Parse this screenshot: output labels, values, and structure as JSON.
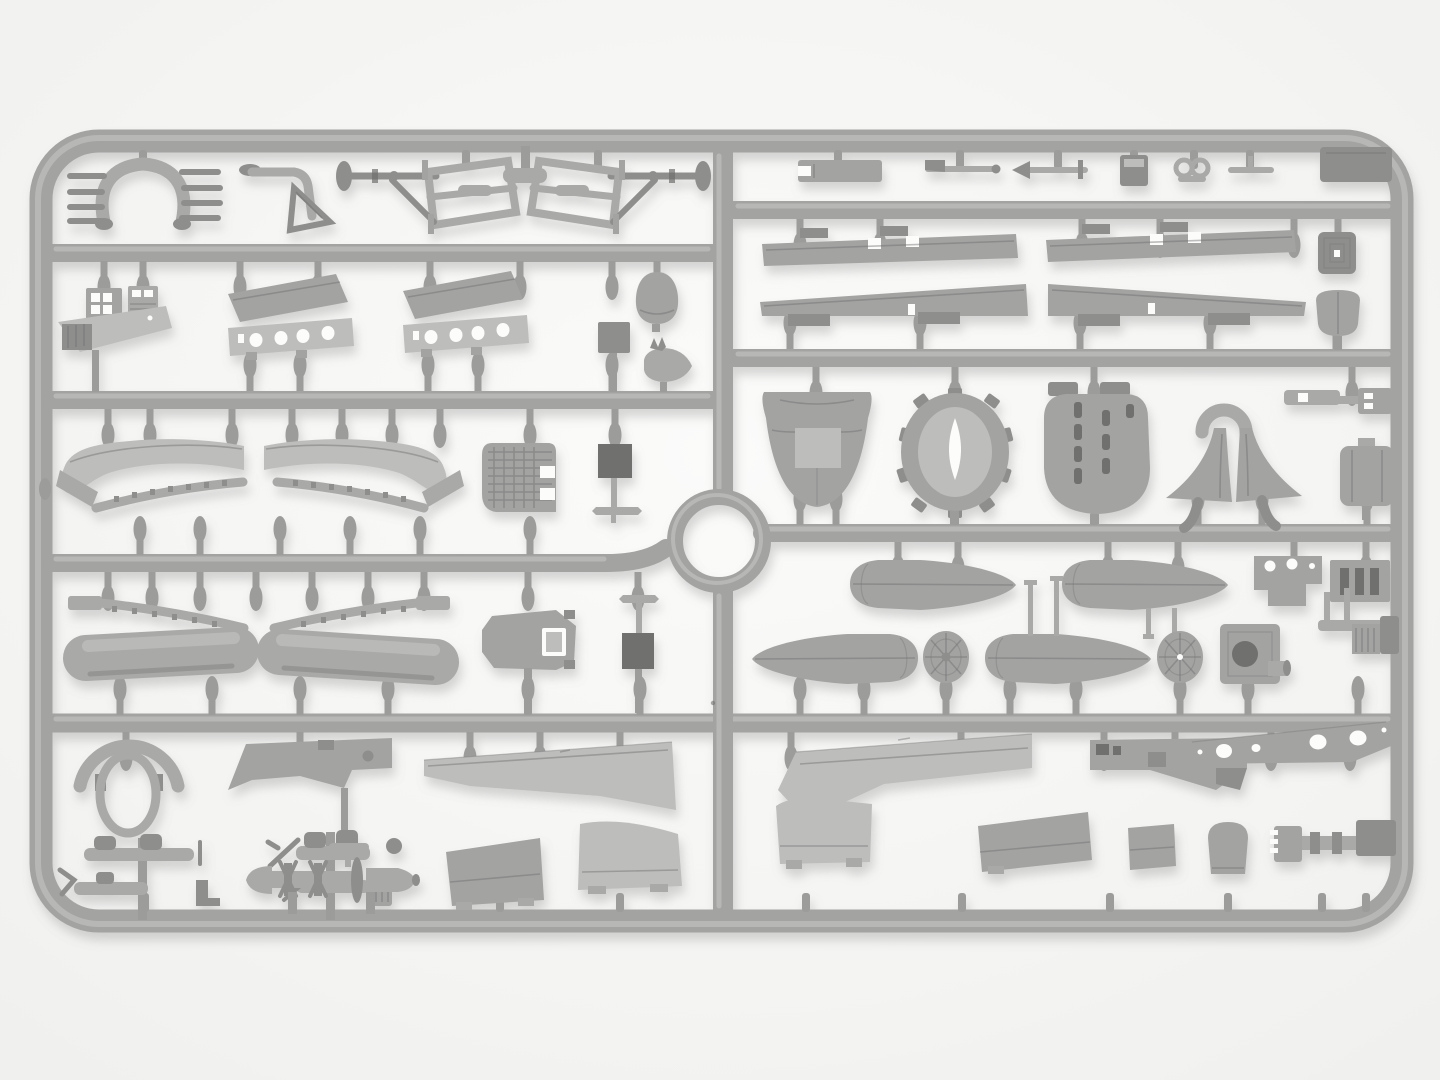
{
  "scene": {
    "kind": "photograph",
    "subject": "injection-molded light-gray styrene sprue of a model aircraft kit, shot on a plain white studio background",
    "orientation": "landscape",
    "sprue_structure": {
      "outer_frame": "rounded rectangle",
      "horizontal_runners_left": 4,
      "horizontal_runners_right": 3,
      "full_width_runner_bottom": 1,
      "vertical_center_divider": true,
      "circular_runner_hub_center": true,
      "gate_count_approx": 80
    }
  },
  "palette": {
    "bg-center": "#fbfbfa",
    "bg-edge": "#f0f0ee",
    "runner-base": "#a3a3a2",
    "runner-highlight": "#c9c9c7",
    "gate-gray": "#9c9c9b",
    "plastic-base": "#a9a9a8",
    "plastic-light": "#bdbdbc",
    "plastic-mid": "#a3a3a2",
    "plastic-dark": "#8e8e8d",
    "plastic-deep": "#6f6f6e",
    "plastic-outline": "#787877",
    "hole-white": "#fcfcfb",
    "shadow": "#8a8a88"
  },
  "parts": [
    {
      "id": "exhaust-collector",
      "label": "Y-shaped exhaust collector with stub pipes",
      "section": "left-row-1"
    },
    {
      "id": "control-column-bracket",
      "label": "bent control column with triangular gusset",
      "section": "left-row-1"
    },
    {
      "id": "landing-gear-frame-left",
      "label": "tubular landing gear frame with axle, left",
      "section": "left-row-1"
    },
    {
      "id": "landing-gear-frame-right",
      "label": "tubular landing gear frame with axle, right",
      "section": "left-row-1"
    },
    {
      "id": "t-connector",
      "label": "T-shaped runner drop",
      "section": "left-row-1"
    },
    {
      "id": "instrument-panel-a",
      "label": "instrument panel with dial openings",
      "section": "left-row-2"
    },
    {
      "id": "instrument-panel-b",
      "label": "instrument panel with louvered face",
      "section": "left-row-2"
    },
    {
      "id": "cockpit-floor-panel",
      "label": "cockpit side panel with radio boxes",
      "section": "left-row-2"
    },
    {
      "id": "wing-center-section-left",
      "label": "wing center-section half with lightening holes",
      "section": "left-row-2"
    },
    {
      "id": "wing-center-section-right",
      "label": "wing center-section half with lightening holes",
      "section": "left-row-2"
    },
    {
      "id": "junction-block",
      "label": "small rectangular junction block",
      "section": "left-row-2"
    },
    {
      "id": "fairing-egg",
      "label": "egg-shaped fairing",
      "section": "left-row-2"
    },
    {
      "id": "spinner-carrot",
      "label": "tear-drop spinner / finial",
      "section": "left-row-2"
    },
    {
      "id": "wing-arch-panel-left",
      "label": "curved wing skin panel, left",
      "section": "left-row-3"
    },
    {
      "id": "wing-arch-panel-right",
      "label": "curved wing skin panel, right",
      "section": "left-row-3"
    },
    {
      "id": "rib-strip-left",
      "label": "ribbed trailing-edge strip, left",
      "section": "left-row-3"
    },
    {
      "id": "rib-strip-right",
      "label": "ribbed trailing-edge strip, right",
      "section": "left-row-3"
    },
    {
      "id": "radiator-core-block",
      "label": "radiator core block with waffle texture",
      "section": "left-row-3"
    },
    {
      "id": "antenna-mast-upper",
      "label": "antenna mast with plate",
      "section": "left-row-3"
    },
    {
      "id": "rib-arc-left",
      "label": "curved rib strip with end tab, left",
      "section": "left-row-4"
    },
    {
      "id": "rib-arc-right",
      "label": "curved rib strip with end tab, right",
      "section": "left-row-4"
    },
    {
      "id": "wing-skin-cylinder-left",
      "label": "rolled wing skin section, left",
      "section": "left-row-4"
    },
    {
      "id": "wing-skin-cylinder-right",
      "label": "rolled wing skin section, right",
      "section": "left-row-4"
    },
    {
      "id": "bulkhead-plate",
      "label": "octagonal bulkhead with window",
      "section": "left-row-4"
    },
    {
      "id": "antenna-mast-lower",
      "label": "mast with crossbar and box",
      "section": "left-row-4"
    },
    {
      "id": "cowl-ring-horseshoe",
      "label": "cowl ring and horseshoe arc",
      "section": "left-row-5"
    },
    {
      "id": "fuselage-deck-bracket",
      "label": "fuselage deck bracket",
      "section": "left-row-5"
    },
    {
      "id": "lower-wing-panel-left",
      "label": "long tapered lower wing panel",
      "section": "left-row-5"
    },
    {
      "id": "wing-tip-panel-a",
      "label": "trapezoid wing tip panel",
      "section": "left-row-5"
    },
    {
      "id": "wing-tip-panel-b",
      "label": "trapezoid wing tip panel",
      "section": "left-row-5"
    },
    {
      "id": "small-parts-cluster-a",
      "label": "cluster of small struts and bombs",
      "section": "left-row-5"
    },
    {
      "id": "small-parts-cluster-b",
      "label": "cluster of small struts and bombs",
      "section": "left-row-5"
    },
    {
      "id": "torpedo-assembly",
      "label": "torpedo body with finned collars and shaft",
      "section": "left-row-5"
    },
    {
      "id": "strut-bar-forked",
      "label": "flat strut bar with forked end",
      "section": "right-row-1"
    },
    {
      "id": "gun-rod-a",
      "label": "thin rod with fin",
      "section": "right-row-1"
    },
    {
      "id": "gun-rod-b",
      "label": "thin rod with arrow head",
      "section": "right-row-1"
    },
    {
      "id": "small-block",
      "label": "small box part",
      "section": "right-row-1"
    },
    {
      "id": "twin-loop-clamp",
      "label": "twin loop clamp",
      "section": "right-row-1"
    },
    {
      "id": "t-rod",
      "label": "small T rod",
      "section": "right-row-1"
    },
    {
      "id": "corner-plate",
      "label": "flat plate tucked at frame corner",
      "section": "right-row-1"
    },
    {
      "id": "aileron-left",
      "label": "aileron plank with hinge tabs, left",
      "section": "right-row-2"
    },
    {
      "id": "aileron-right",
      "label": "aileron plank with hinge tabs, right",
      "section": "right-row-2"
    },
    {
      "id": "radiator-grille-plate",
      "label": "small radiator grille plate",
      "section": "right-row-2"
    },
    {
      "id": "leading-edge-strip-left",
      "label": "wing leading-edge wedge strip, left",
      "section": "right-row-2"
    },
    {
      "id": "leading-edge-strip-right",
      "label": "wing leading-edge wedge strip, right",
      "section": "right-row-2"
    },
    {
      "id": "exhaust-shield",
      "label": "rounded exhaust shield",
      "section": "right-row-2"
    },
    {
      "id": "nose-cowling",
      "label": "conical nose cowling",
      "section": "right-row-3"
    },
    {
      "id": "cowl-ring-front",
      "label": "castellated cowl ring with keyhole opening",
      "section": "right-row-3"
    },
    {
      "id": "louvered-cowl-panel",
      "label": "cowl dome with louver slots",
      "section": "right-row-3"
    },
    {
      "id": "wheel-spat-halves",
      "label": "wheel spat halves under arch",
      "section": "right-row-3"
    },
    {
      "id": "pipe-bracket",
      "label": "pipe tee bracket",
      "section": "right-row-3"
    },
    {
      "id": "canister-box",
      "label": "rounded canister box",
      "section": "right-row-3"
    },
    {
      "id": "fuel-tank-half-a",
      "label": "tear-drop fuel tank half",
      "section": "right-row-4"
    },
    {
      "id": "fuel-tank-half-b",
      "label": "tear-drop fuel tank half with struts",
      "section": "right-row-4"
    },
    {
      "id": "float-half-a",
      "label": "tear-drop float half, mirrored",
      "section": "right-row-4"
    },
    {
      "id": "float-half-b",
      "label": "tear-drop float half with masts",
      "section": "right-row-4"
    },
    {
      "id": "spoked-wheel-a",
      "label": "spoked wheel disc",
      "section": "right-row-4"
    },
    {
      "id": "spoked-wheel-b",
      "label": "spoked wheel disc with hub hole",
      "section": "right-row-4"
    },
    {
      "id": "engine-mount-box",
      "label": "engine mount box with round opening",
      "section": "right-row-4"
    },
    {
      "id": "instrument-consoles",
      "label": "console panels with cutouts and slats",
      "section": "right-row-4"
    },
    {
      "id": "carburetor-assembly",
      "label": "small carburetor / pump assembly",
      "section": "right-row-4"
    },
    {
      "id": "outer-wing-panel",
      "label": "long outer wing panel",
      "section": "right-row-5"
    },
    {
      "id": "fuselage-step-bracket",
      "label": "stepped fuselage bracket",
      "section": "right-row-5"
    },
    {
      "id": "walkway-panel-with-holes",
      "label": "slanted panel with round lightening holes",
      "section": "right-row-5"
    },
    {
      "id": "wing-tip-panel-c",
      "label": "curved wing tip panel",
      "section": "right-row-5"
    },
    {
      "id": "wing-tip-panel-d",
      "label": "trapezoid wing panel",
      "section": "right-row-5"
    },
    {
      "id": "access-panel-small",
      "label": "small access panel",
      "section": "right-row-5"
    },
    {
      "id": "tombstone-panel",
      "label": "rounded-top small panel",
      "section": "right-row-5"
    },
    {
      "id": "rib-comb-assembly",
      "label": "ribbed comb block assembly",
      "section": "right-row-5"
    }
  ]
}
